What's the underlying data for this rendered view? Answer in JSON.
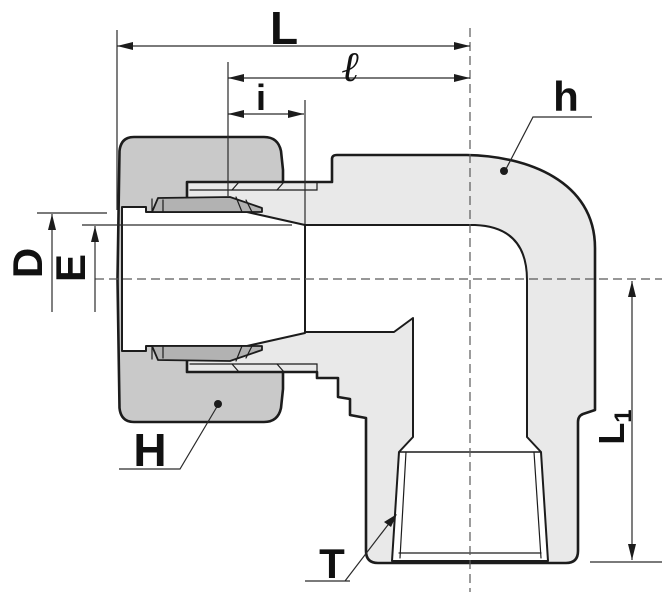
{
  "drawing": {
    "kind": "fitting-cross-section-elbow",
    "labels": {
      "overall_length": "L",
      "ell_length": "ℓ",
      "insertion_depth": "i",
      "body_ref": "h",
      "tube_hole_dia": "D",
      "bore_dia": "E",
      "nut_ref": "H",
      "thread_ref": "T",
      "leg_length_main": "L",
      "leg_length_sub": "1"
    },
    "colors": {
      "background": "#ffffff",
      "body_fill": "#e9e9e9",
      "nut_fill": "#c9c9c9",
      "ferrule_fill": "#b2b2b2",
      "line": "#1c1c1c",
      "dimension_line": "#2a2a2a",
      "centerline": "#595959"
    }
  }
}
